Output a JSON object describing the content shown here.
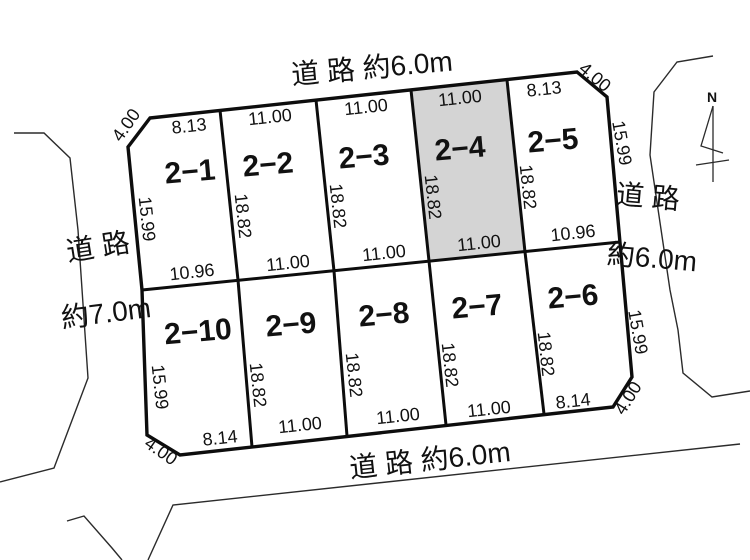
{
  "meta": {
    "description": "Land subdivision plot diagram, 10 numbered lots surrounded by roads",
    "highlighted_plot": "2−4"
  },
  "colors": {
    "thick_line": "#0d0d0d",
    "thin_line": "#2b2b2b",
    "highlight_fill": "#d4d4d4",
    "highlight_text": "#e60012",
    "background": "#ffffff"
  },
  "plots": {
    "row1": [
      "2−1",
      "2−2",
      "2−3",
      "2−4",
      "2−5"
    ],
    "row2": [
      "2−10",
      "2−9",
      "2−8",
      "2−7",
      "2−6"
    ]
  },
  "dims": {
    "top": [
      "8.13",
      "11.00",
      "11.00",
      "11.00",
      "8.13"
    ],
    "middle": [
      "10.96",
      "11.00",
      "11.00",
      "11.00",
      "10.96"
    ],
    "bottom": [
      "8.14",
      "11.00",
      "11.00",
      "11.00",
      "8.14"
    ],
    "left": [
      "15.99",
      "15.99"
    ],
    "right": [
      "15.99",
      "15.99"
    ],
    "inner_top": [
      "18.82",
      "18.82",
      "18.82",
      "18.82"
    ],
    "inner_bottom": [
      "18.82",
      "18.82",
      "18.82",
      "18.82"
    ],
    "cuts": [
      "4.00",
      "4.00",
      "4.00",
      "4.00"
    ]
  },
  "roads": {
    "top": "道 路 約6.0m",
    "bottom": "道 路 約6.0m",
    "left_name": "道 路",
    "left_width": "約7.0m",
    "right_name": "道 路",
    "right_width": "約6.0m"
  },
  "north": {
    "label": "N"
  }
}
